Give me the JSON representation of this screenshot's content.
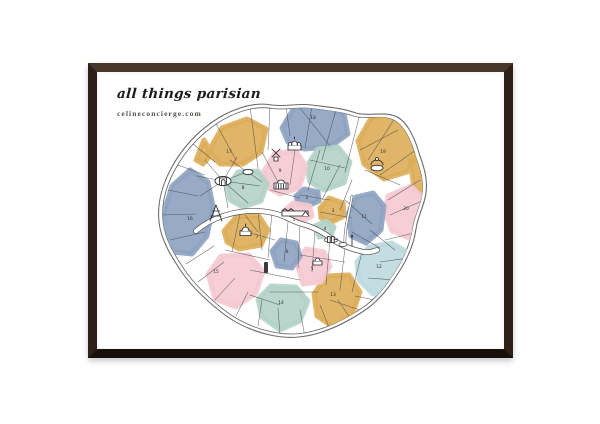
{
  "poster": {
    "title": "all things parisian",
    "website": "celineconcierge.com"
  },
  "frame": {
    "top_color": "#4a372b",
    "side_color": "#2e2019",
    "bottom_color": "#17100c"
  },
  "palette": {
    "paper": "#ffffff",
    "ink": "#3f3f45",
    "blue": "#8da2c0",
    "ochre": "#ddad58",
    "pink": "#f4c9d2",
    "teal": "#b2d2c8",
    "lightblue": "#bcd9de"
  },
  "map": {
    "name": "paris-arrondissement-map",
    "arrondissements": [
      {
        "num": 1,
        "color": "pink",
        "x": 294,
        "y": 221
      },
      {
        "num": 2,
        "color": "blue",
        "x": 307,
        "y": 199
      },
      {
        "num": 3,
        "color": "ochre",
        "x": 333,
        "y": 212
      },
      {
        "num": 4,
        "color": "teal",
        "x": 325,
        "y": 230
      },
      {
        "num": 5,
        "color": "pink",
        "x": 312,
        "y": 270
      },
      {
        "num": 6,
        "color": "blue",
        "x": 287,
        "y": 253
      },
      {
        "num": 7,
        "color": "ochre",
        "x": 257,
        "y": 238
      },
      {
        "num": 8,
        "color": "teal",
        "x": 243,
        "y": 189
      },
      {
        "num": 9,
        "color": "pink",
        "x": 280,
        "y": 172
      },
      {
        "num": 10,
        "color": "teal",
        "x": 327,
        "y": 170
      },
      {
        "num": 11,
        "color": "blue",
        "x": 364,
        "y": 218
      },
      {
        "num": 12,
        "color": "lightblue",
        "x": 379,
        "y": 268
      },
      {
        "num": 13,
        "color": "ochre",
        "x": 333,
        "y": 296
      },
      {
        "num": 14,
        "color": "teal",
        "x": 281,
        "y": 304
      },
      {
        "num": 15,
        "color": "pink",
        "x": 216,
        "y": 273
      },
      {
        "num": 16,
        "color": "blue",
        "x": 190,
        "y": 220
      },
      {
        "num": 17,
        "color": "ochre",
        "x": 229,
        "y": 153
      },
      {
        "num": 18,
        "color": "blue",
        "x": 313,
        "y": 119
      },
      {
        "num": 19,
        "color": "ochre",
        "x": 383,
        "y": 153
      },
      {
        "num": 20,
        "color": "pink",
        "x": 406,
        "y": 210
      }
    ],
    "landmarks": [
      "arc-de-triomphe",
      "eiffel-tower",
      "sacre-coeur",
      "moulin-rouge",
      "opera-garnier",
      "louvre",
      "invalides",
      "notre-dame",
      "pantheon",
      "montparnasse-tower",
      "bastille-column",
      "buttes-chaumont",
      "cloud"
    ]
  }
}
